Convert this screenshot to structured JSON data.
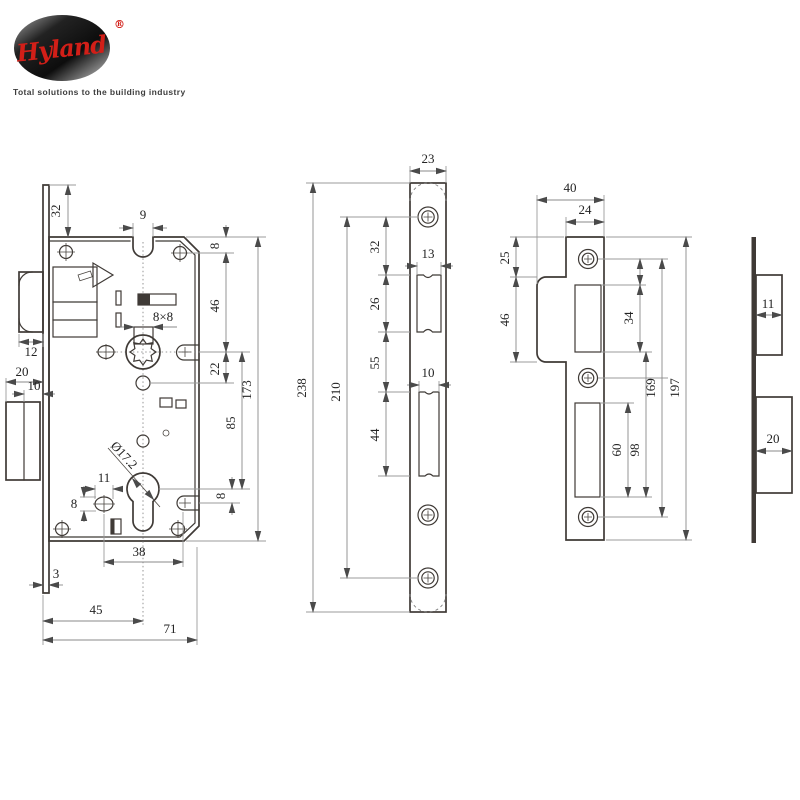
{
  "logo": {
    "brand": "Hyland",
    "registered": "®",
    "tagline": "Total solutions to the building industry"
  },
  "colors": {
    "line": "#3f3a36",
    "dimension": "#8a8a8a",
    "text": "#232323",
    "brand_red": "#d21f18",
    "background": "#ffffff"
  },
  "lock_body_view": {
    "name": "mortise lock case side view",
    "dims": {
      "faceplate_top_offset": "32",
      "notch_width": "9",
      "top_to_screw": "8",
      "screw_to_follower": "46",
      "follower_to_aux": "22",
      "body_height": "173",
      "follower_to_cylinder": "85",
      "cylinder_to_slot": "8",
      "spindle_square": "8×8",
      "latch_bolt_width": "12",
      "deadbolt_width": "20",
      "deadbolt_throw": "10",
      "cylinder_diameter": "Ø17.2",
      "oval_hole_width": "11",
      "oval_hole_height": "8",
      "oval_to_slot": "38",
      "faceplate_thickness": "3",
      "backset": "45",
      "case_depth": "71"
    }
  },
  "faceplate_view": {
    "name": "forend faceplate front view",
    "dims": {
      "width": "23",
      "height": "238",
      "screw_spacing": "210",
      "screw_to_latch_opening": "32",
      "latch_opening_height": "26",
      "latch_opening_width": "13",
      "latch_to_deadbolt_opening": "55",
      "deadbolt_opening_height": "44",
      "deadbolt_opening_width": "10"
    }
  },
  "strike_plate_view": {
    "name": "strike plate front view",
    "dims": {
      "width": "40",
      "plate_width": "24",
      "top_to_flange": "25",
      "flange_height": "46",
      "latch_opening_height": "34",
      "screw_spacing": "169",
      "height": "197",
      "deadbolt_opening_height": "60",
      "latch_to_deadbolt_bottom": "98"
    }
  },
  "strike_side_view": {
    "name": "strike plate side view",
    "dims": {
      "latch_box_depth": "11",
      "deadbolt_box_depth": "20"
    }
  }
}
